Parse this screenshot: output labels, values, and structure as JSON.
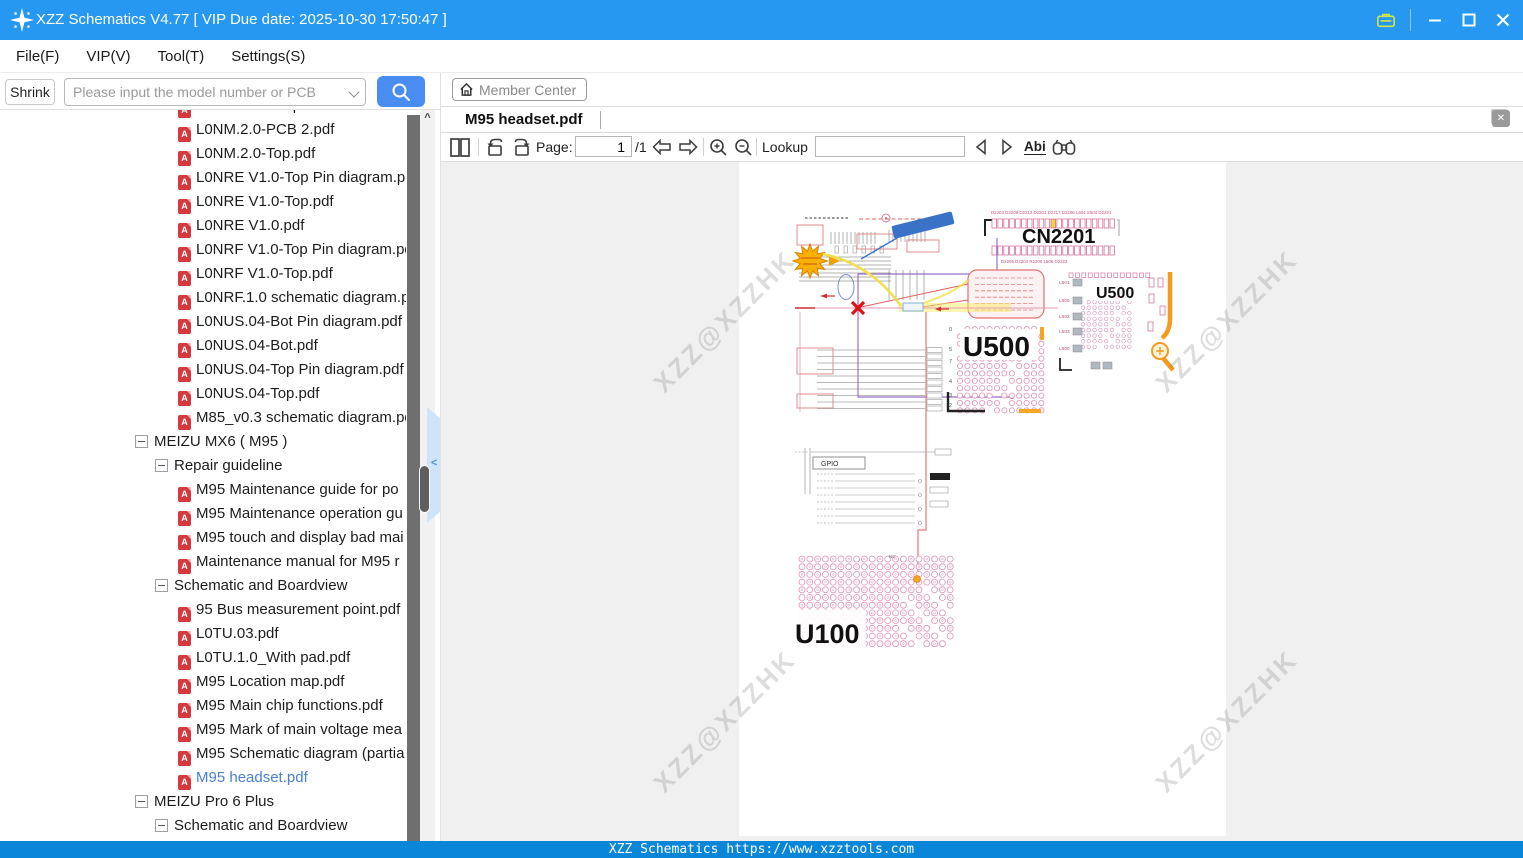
{
  "title_bar": {
    "app_title": "XZZ Schematics V4.77 [ VIP Due date: 2025-10-30 17:50:47 ]"
  },
  "menu_bar": {
    "items": [
      "File(F)",
      "VIP(V)",
      "Tool(T)",
      "Settings(S)"
    ]
  },
  "search_bar": {
    "shrink_label": "Shrink",
    "search_placeholder": "Please input the model number or PCB"
  },
  "member_bar": {
    "member_center_label": "Member Center"
  },
  "rail": {
    "groups": [
      {
        "label": "VIP",
        "items": [
          {
            "label": "Cour...",
            "icon": "play-circle-icon",
            "active": false
          },
          {
            "label": "Phone",
            "icon": "smartphone-icon",
            "active": true
          },
          {
            "label": "Com...",
            "icon": "laptop-icon",
            "active": false
          }
        ]
      },
      {
        "label": "Custom",
        "items": [
          {
            "label": "Drone",
            "icon": "drone-icon",
            "active": false
          },
          {
            "label": "Gam...",
            "icon": "gamepad-icon",
            "active": false
          },
          {
            "label": "Car",
            "icon": "car-icon",
            "active": false
          }
        ]
      }
    ],
    "favorites": {
      "label": "Favorites",
      "icon": "star-icon"
    }
  },
  "file_tree": {
    "items": [
      {
        "type": "file",
        "indent": 178,
        "label": "L0NM.2.0-Bot.pdf"
      },
      {
        "type": "file",
        "indent": 178,
        "label": "L0NM.2.0-PCB 2.pdf"
      },
      {
        "type": "file",
        "indent": 178,
        "label": "L0NM.2.0-Top.pdf"
      },
      {
        "type": "file",
        "indent": 178,
        "label": "L0NRE V1.0-Top Pin diagram.pdf"
      },
      {
        "type": "file",
        "indent": 178,
        "label": "L0NRE V1.0-Top.pdf"
      },
      {
        "type": "file",
        "indent": 178,
        "label": "L0NRE V1.0.pdf"
      },
      {
        "type": "file",
        "indent": 178,
        "label": "L0NRF V1.0-Top Pin diagram.pdf"
      },
      {
        "type": "file",
        "indent": 178,
        "label": "L0NRF V1.0-Top.pdf"
      },
      {
        "type": "file",
        "indent": 178,
        "label": "L0NRF.1.0 schematic diagram.pdf"
      },
      {
        "type": "file",
        "indent": 178,
        "label": "L0NUS.04-Bot Pin diagram.pdf"
      },
      {
        "type": "file",
        "indent": 178,
        "label": "L0NUS.04-Bot.pdf"
      },
      {
        "type": "file",
        "indent": 178,
        "label": "L0NUS.04-Top Pin diagram.pdf"
      },
      {
        "type": "file",
        "indent": 178,
        "label": "L0NUS.04-Top.pdf"
      },
      {
        "type": "file",
        "indent": 178,
        "label": "M85_v0.3 schematic diagram.pdf"
      },
      {
        "type": "group",
        "indent": 135,
        "label": "MEIZU MX6 ( M95 )"
      },
      {
        "type": "group",
        "indent": 155,
        "label": "Repair guideline"
      },
      {
        "type": "file",
        "indent": 178,
        "label": "M95 Maintenance guide for po"
      },
      {
        "type": "file",
        "indent": 178,
        "label": "M95 Maintenance operation gu"
      },
      {
        "type": "file",
        "indent": 178,
        "label": "M95 touch and display bad mai"
      },
      {
        "type": "file",
        "indent": 178,
        "label": "Maintenance manual for M95 r"
      },
      {
        "type": "group",
        "indent": 155,
        "label": "Schematic and Boardview"
      },
      {
        "type": "file",
        "indent": 178,
        "label": "95 Bus measurement point.pdf"
      },
      {
        "type": "file",
        "indent": 178,
        "label": "L0TU.03.pdf"
      },
      {
        "type": "file",
        "indent": 178,
        "label": "L0TU.1.0_With pad.pdf"
      },
      {
        "type": "file",
        "indent": 178,
        "label": "M95 Location map.pdf"
      },
      {
        "type": "file",
        "indent": 178,
        "label": "M95 Main chip functions.pdf"
      },
      {
        "type": "file",
        "indent": 178,
        "label": "M95 Mark of main voltage mea"
      },
      {
        "type": "file",
        "indent": 178,
        "label": "M95 Schematic diagram (partia"
      },
      {
        "type": "file",
        "indent": 178,
        "label": "M95 headset.pdf",
        "selected": true
      },
      {
        "type": "group",
        "indent": 135,
        "label": "MEIZU Pro 6 Plus"
      },
      {
        "type": "group",
        "indent": 155,
        "label": "Schematic and Boardview"
      }
    ]
  },
  "viewer": {
    "tab_label": "M95 headset.pdf",
    "toolbar": {
      "page_label": "Page:",
      "page_value": "1",
      "page_count": "/1",
      "lookup_label": "Lookup",
      "lookup_value": "",
      "match_label": "Abi"
    },
    "watermark_text": "XZZ@XZZHK",
    "schematic": {
      "connector_label": "CN2201",
      "connector_top_labels": "D2203 D2209 D2212 D2201 D2217 D2206   L504   S504   D2221",
      "connector_bottom_labels": "D2205 D2204        R2200   L506   D2222",
      "bga_large_label": "U500",
      "board_label": "U500",
      "bga_row_numbers": [
        "0",
        "5",
        "7",
        "4",
        "3",
        "2"
      ],
      "cpu_label": "U100",
      "gpio_label": "GPIO",
      "inductor_labels": [
        "L501",
        "L505",
        "L502",
        "L503",
        "L500"
      ],
      "nc_label": "NC"
    }
  },
  "status_bar": {
    "text": "XZZ Schematics https://www.xzztools.com"
  },
  "colors": {
    "titlebar_blue": "#2698f2",
    "accent_blue": "#4a8df2",
    "statusbar_blue": "#0a86d8",
    "selected_item_blue": "#4a7fd4",
    "pdf_red": "#d6383c",
    "schematic_pink": "#e090b8",
    "schematic_orange": "#f5a623",
    "highlight_yellow": "#f2e04a"
  }
}
